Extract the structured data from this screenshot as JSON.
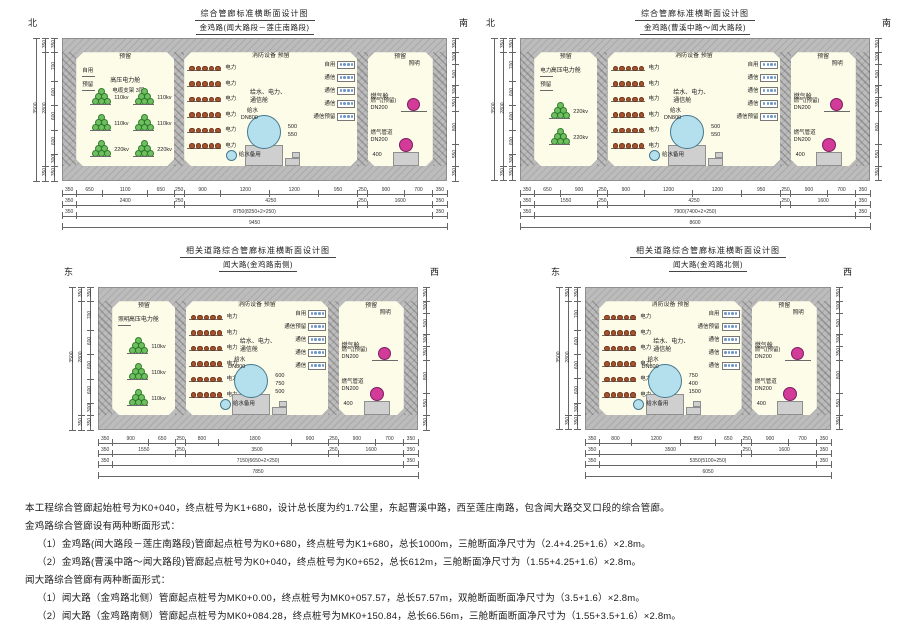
{
  "page": {
    "bg": "#ffffff"
  },
  "colors": {
    "concrete": "#bcbcbc",
    "cabin_fill": "#fdfce9",
    "water_pipe": "#b4e0ee",
    "gas_pipe": "#d23b97",
    "cable_trefoil": "#6fbf5f",
    "power_dot": "#a4542e",
    "comm_dot": "#6f97c8",
    "dim_line": "#666666"
  },
  "notes": [
    "本工程综合管廊起始桩号为K0+040，终点桩号为K1+680，设计总长度为约1.7公里，东起曹溪中路，西至莲庄南路，包含闻大路交叉口段的综合管廊。",
    "金鸡路综合管廊设有两种断面形式：",
    "（1）金鸡路(闻大路段－莲庄南路段)管廊起点桩号为K0+680，终点桩号为K1+680，总长1000m，三舱断面净尺寸为（2.4+4.25+1.6）×2.8m。",
    "（2）金鸡路(曹溪中路～闻大路段)管廊起点桩号为K0+040，终点桩号为K0+652，总长612m，三舱断面净尺寸为（1.55+4.25+1.6）×2.8m。",
    "闻大路综合管廊有两种断面形式：",
    "（1）闻大路（金鸡路北侧）管廊起点桩号为MK0+0.00，终点桩号为MK0+057.57，总长57.57m，双舱断面断面净尺寸为（3.5+1.6）×2.8m。",
    "（2）闻大路（金鸡路南侧）管廊起点桩号为MK0+084.28，终点桩号为MK0+150.84，总长66.56m，三舱断面断面净尺寸为（1.55+3.5+1.6）×2.8m。"
  ],
  "diagrams": [
    {
      "title": "综合管廊标准横断面设计图",
      "subtitle": "金鸡路(闻大路段－莲庄南路段)",
      "compass_left": "北",
      "compass_right": "南",
      "px": {
        "x": 15,
        "y": 8,
        "w": 482,
        "h": 236,
        "tx": 47,
        "ty": 30,
        "tw": 385,
        "th": 143,
        "cy": 8
      },
      "layout_mm": [
        350,
        2400,
        250,
        4250,
        250,
        1600,
        350
      ],
      "cabins": [
        {
          "type": "hv",
          "name": "高压电力舱",
          "sub": "电缆支架 3层",
          "top_label": "预留",
          "shelf_labels": [
            "自用",
            "预留"
          ],
          "columns": 2,
          "bundles": [
            [
              "110kv",
              "110kv"
            ],
            [
              "110kv",
              "110kv"
            ],
            [
              "220kv",
              "220kv"
            ]
          ]
        },
        {
          "type": "util",
          "top_label": "消防设备  预留",
          "power_label": "电力",
          "power_rows": 6,
          "name_lines": [
            "给水、电力、",
            "通信舱"
          ],
          "comm_labels": [
            "自用",
            "通信",
            "通信",
            "通信",
            "通信预留"
          ],
          "water_main": [
            "给水",
            "DN800"
          ],
          "water_spare": "给水备用",
          "inner_dims": [
            "500",
            "550"
          ]
        },
        {
          "type": "gas",
          "name": "燃气舱",
          "top_label": "预留",
          "side_label": "照明",
          "pipe_upper": [
            "燃气(预留)",
            "DN200"
          ],
          "pipe_lower": [
            "燃气管道",
            "DN200"
          ],
          "lower_dim": "400"
        }
      ],
      "dim_rows": [
        [
          [
            "350",
            350
          ],
          [
            "650",
            650
          ],
          [
            "1100",
            1100
          ],
          [
            "650",
            650
          ],
          [
            "250",
            250
          ],
          [
            "900",
            900
          ],
          [
            "1200",
            1200
          ],
          [
            "1200",
            1200
          ],
          [
            "950",
            950
          ],
          [
            "250",
            250
          ],
          [
            "900",
            900
          ],
          [
            "700",
            700
          ],
          [
            "350",
            350
          ]
        ],
        [
          [
            "350",
            350
          ],
          [
            "2400",
            2400
          ],
          [
            "250",
            250
          ],
          [
            "4250",
            4250
          ],
          [
            "250",
            250
          ],
          [
            "1600",
            1600
          ],
          [
            "350",
            350
          ]
        ],
        [
          [
            "350",
            350
          ],
          [
            "8750(8250+2×250)",
            8750
          ],
          [
            "350",
            350
          ]
        ],
        [
          [
            "9450",
            9450
          ]
        ]
      ],
      "left_dims": [
        [
          "350",
          350
        ],
        [
          "700",
          700
        ],
        [
          "600",
          600
        ],
        [
          "600",
          600
        ],
        [
          "600",
          600
        ],
        [
          "300",
          300
        ],
        [
          "350",
          350
        ]
      ],
      "left_outer": [
        [
          "350",
          350
        ],
        [
          "2800",
          2800
        ],
        [
          "350",
          350
        ]
      ],
      "left_total": "3500",
      "right_dims": [
        [
          "350",
          350
        ],
        [
          "300",
          300
        ],
        [
          "500",
          500
        ],
        [
          "300",
          300
        ],
        [
          "350",
          350
        ],
        [
          "800",
          800
        ],
        [
          "550",
          550
        ],
        [
          "350",
          350
        ]
      ]
    },
    {
      "title": "综合管廊标准横断面设计图",
      "subtitle": "金鸡路(曹溪中路～闻大路段)",
      "compass_left": "北",
      "compass_right": "南",
      "px": {
        "x": 495,
        "y": 8,
        "w": 410,
        "h": 236,
        "tx": 25,
        "ty": 30,
        "tw": 350,
        "th": 143,
        "cy": 8
      },
      "layout_mm": [
        350,
        1550,
        250,
        4250,
        250,
        1600,
        350
      ],
      "cabins": [
        {
          "type": "hv",
          "name": "高压电力舱",
          "sub": "",
          "top_label": "预留",
          "shelf_labels": [
            "电力",
            "预留"
          ],
          "columns": 1,
          "bundles": [
            [
              "220kv"
            ],
            [
              "220kv"
            ]
          ]
        },
        {
          "type": "util",
          "top_label": "消防设备  预留",
          "power_label": "电力",
          "power_rows": 6,
          "name_lines": [
            "给水、电力、",
            "通信舱"
          ],
          "comm_labels": [
            "自用",
            "通信",
            "通信",
            "通信",
            "通信预留"
          ],
          "water_main": [
            "给水",
            "DN800"
          ],
          "water_spare": "给水备用",
          "inner_dims": [
            "500",
            "550"
          ]
        },
        {
          "type": "gas",
          "name": "燃气舱",
          "top_label": "预留",
          "side_label": "照明",
          "pipe_upper": [
            "燃气(预留)",
            "DN200"
          ],
          "pipe_lower": [
            "燃气管道",
            "DN200"
          ],
          "lower_dim": "400"
        }
      ],
      "dim_rows": [
        [
          [
            "350",
            350
          ],
          [
            "650",
            650
          ],
          [
            "900",
            900
          ],
          [
            "250",
            250
          ],
          [
            "900",
            900
          ],
          [
            "1200",
            1200
          ],
          [
            "1200",
            1200
          ],
          [
            "950",
            950
          ],
          [
            "250",
            250
          ],
          [
            "900",
            900
          ],
          [
            "700",
            700
          ],
          [
            "350",
            350
          ]
        ],
        [
          [
            "350",
            350
          ],
          [
            "1550",
            1550
          ],
          [
            "250",
            250
          ],
          [
            "4250",
            4250
          ],
          [
            "250",
            250
          ],
          [
            "1600",
            1600
          ],
          [
            "350",
            350
          ]
        ],
        [
          [
            "350",
            350
          ],
          [
            "7900(7400+2×250)",
            7900
          ],
          [
            "350",
            350
          ]
        ],
        [
          [
            "8600",
            8600
          ]
        ]
      ],
      "left_dims": [
        [
          "350",
          350
        ],
        [
          "700",
          700
        ],
        [
          "600",
          600
        ],
        [
          "600",
          600
        ],
        [
          "600",
          600
        ],
        [
          "300",
          300
        ],
        [
          "350",
          350
        ]
      ],
      "left_outer": [
        [
          "350",
          350
        ],
        [
          "2800",
          2800
        ],
        [
          "350",
          350
        ]
      ],
      "left_total": "3500",
      "right_dims": [
        [
          "350",
          350
        ],
        [
          "300",
          300
        ],
        [
          "500",
          500
        ],
        [
          "300",
          300
        ],
        [
          "350",
          350
        ],
        [
          "800",
          800
        ],
        [
          "550",
          550
        ],
        [
          "350",
          350
        ]
      ]
    },
    {
      "title": "相关道路综合管廊标准横断面设计图",
      "subtitle": "闻大路(金鸡路南侧)",
      "compass_left": "东",
      "compass_right": "西",
      "px": {
        "x": 60,
        "y": 245,
        "w": 440,
        "h": 248,
        "tx": 38,
        "ty": 42,
        "tw": 320,
        "th": 143,
        "cy": 20
      },
      "layout_mm": [
        350,
        1550,
        250,
        3500,
        250,
        1600,
        350
      ],
      "cabins": [
        {
          "type": "hv",
          "name": "高压电力舱",
          "sub": "",
          "top_label": "预留",
          "shelf_labels": [
            "照明"
          ],
          "columns": 1,
          "bundles": [
            [
              "110kv"
            ],
            [
              "110kv"
            ],
            [
              "110kv"
            ]
          ]
        },
        {
          "type": "util",
          "top_label": "消防设备  预留",
          "power_label": "电力",
          "power_rows": 6,
          "name_lines": [
            "给水、电力、",
            "通信舱"
          ],
          "comm_labels": [
            "自用",
            "通信预留",
            "通信",
            "通信",
            "通信"
          ],
          "water_main": [
            "给水",
            "DN800"
          ],
          "water_spare": "给水备用",
          "inner_dims": [
            "600",
            "750",
            "500"
          ]
        },
        {
          "type": "gas",
          "name": "燃气舱",
          "top_label": "预留",
          "side_label": "照明",
          "pipe_upper": [
            "燃气(预留)",
            "DN200"
          ],
          "pipe_lower": [
            "燃气管道",
            "DN200"
          ],
          "lower_dim": "400"
        }
      ],
      "dim_rows": [
        [
          [
            "350",
            350
          ],
          [
            "900",
            900
          ],
          [
            "650",
            650
          ],
          [
            "250",
            250
          ],
          [
            "800",
            800
          ],
          [
            "1800",
            1800
          ],
          [
            "900",
            900
          ],
          [
            "250",
            250
          ],
          [
            "900",
            900
          ],
          [
            "700",
            700
          ],
          [
            "350",
            350
          ]
        ],
        [
          [
            "350",
            350
          ],
          [
            "1550",
            1550
          ],
          [
            "250",
            250
          ],
          [
            "3500",
            3500
          ],
          [
            "250",
            250
          ],
          [
            "1600",
            1600
          ],
          [
            "350",
            350
          ]
        ],
        [
          [
            "350",
            350
          ],
          [
            "7150(6650+2×250)",
            7150
          ],
          [
            "350",
            350
          ]
        ],
        [
          [
            "7850",
            7850
          ]
        ]
      ],
      "left_dims": [
        [
          "350",
          350
        ],
        [
          "700",
          700
        ],
        [
          "600",
          600
        ],
        [
          "600",
          600
        ],
        [
          "600",
          600
        ],
        [
          "300",
          300
        ],
        [
          "350",
          350
        ]
      ],
      "left_outer": [
        [
          "350",
          350
        ],
        [
          "2800",
          2800
        ],
        [
          "350",
          350
        ]
      ],
      "left_total": "3500",
      "right_dims": [
        [
          "350",
          350
        ],
        [
          "300",
          300
        ],
        [
          "500",
          500
        ],
        [
          "300",
          300
        ],
        [
          "350",
          350
        ],
        [
          "800",
          800
        ],
        [
          "550",
          550
        ],
        [
          "350",
          350
        ]
      ]
    },
    {
      "title": "相关道路综合管廊标准横断面设计图",
      "subtitle": "闻大路(金鸡路北侧)",
      "compass_left": "东",
      "compass_right": "西",
      "px": {
        "x": 545,
        "y": 245,
        "w": 360,
        "h": 248,
        "tx": 40,
        "ty": 42,
        "tw": 246,
        "th": 143,
        "cy": 20
      },
      "layout_mm": [
        350,
        3500,
        250,
        1600,
        350
      ],
      "cabins": [
        {
          "type": "util",
          "top_label": "消防设备  预留",
          "power_label": "电力",
          "power_rows": 6,
          "name_lines": [
            "给水、电力、",
            "通信舱"
          ],
          "comm_labels": [
            "自用",
            "通信预留",
            "通信",
            "通信",
            "通信"
          ],
          "water_main": [
            "给水",
            "DN800"
          ],
          "water_spare": "给水备用",
          "inner_dims": [
            "750",
            "400",
            "1500"
          ]
        },
        {
          "type": "gas",
          "name": "燃气舱",
          "top_label": "预留",
          "side_label": "照明",
          "pipe_upper": [
            "燃气(预留)",
            "DN200"
          ],
          "pipe_lower": [
            "燃气管道",
            "DN200"
          ],
          "lower_dim": "400"
        }
      ],
      "dim_rows": [
        [
          [
            "350",
            350
          ],
          [
            "800",
            800
          ],
          [
            "1200",
            1200
          ],
          [
            "850",
            850
          ],
          [
            "650",
            650
          ],
          [
            "250",
            250
          ],
          [
            "900",
            900
          ],
          [
            "700",
            700
          ],
          [
            "350",
            350
          ]
        ],
        [
          [
            "350",
            350
          ],
          [
            "3500",
            3500
          ],
          [
            "250",
            250
          ],
          [
            "1600",
            1600
          ],
          [
            "350",
            350
          ]
        ],
        [
          [
            "350",
            350
          ],
          [
            "5350(5100+250)",
            5350
          ],
          [
            "350",
            350
          ]
        ],
        [
          [
            "6050",
            6050
          ]
        ]
      ],
      "left_dims": [
        [
          "350",
          350
        ],
        [
          "700",
          700
        ],
        [
          "600",
          600
        ],
        [
          "600",
          600
        ],
        [
          "600",
          600
        ],
        [
          "300",
          300
        ],
        [
          "350",
          350
        ]
      ],
      "left_outer": [
        [
          "350",
          350
        ],
        [
          "2800",
          2800
        ],
        [
          "350",
          350
        ]
      ],
      "left_total": "3500",
      "right_dims": [
        [
          "350",
          350
        ],
        [
          "300",
          300
        ],
        [
          "500",
          500
        ],
        [
          "300",
          300
        ],
        [
          "350",
          350
        ],
        [
          "800",
          800
        ],
        [
          "550",
          550
        ],
        [
          "350",
          350
        ]
      ]
    }
  ]
}
